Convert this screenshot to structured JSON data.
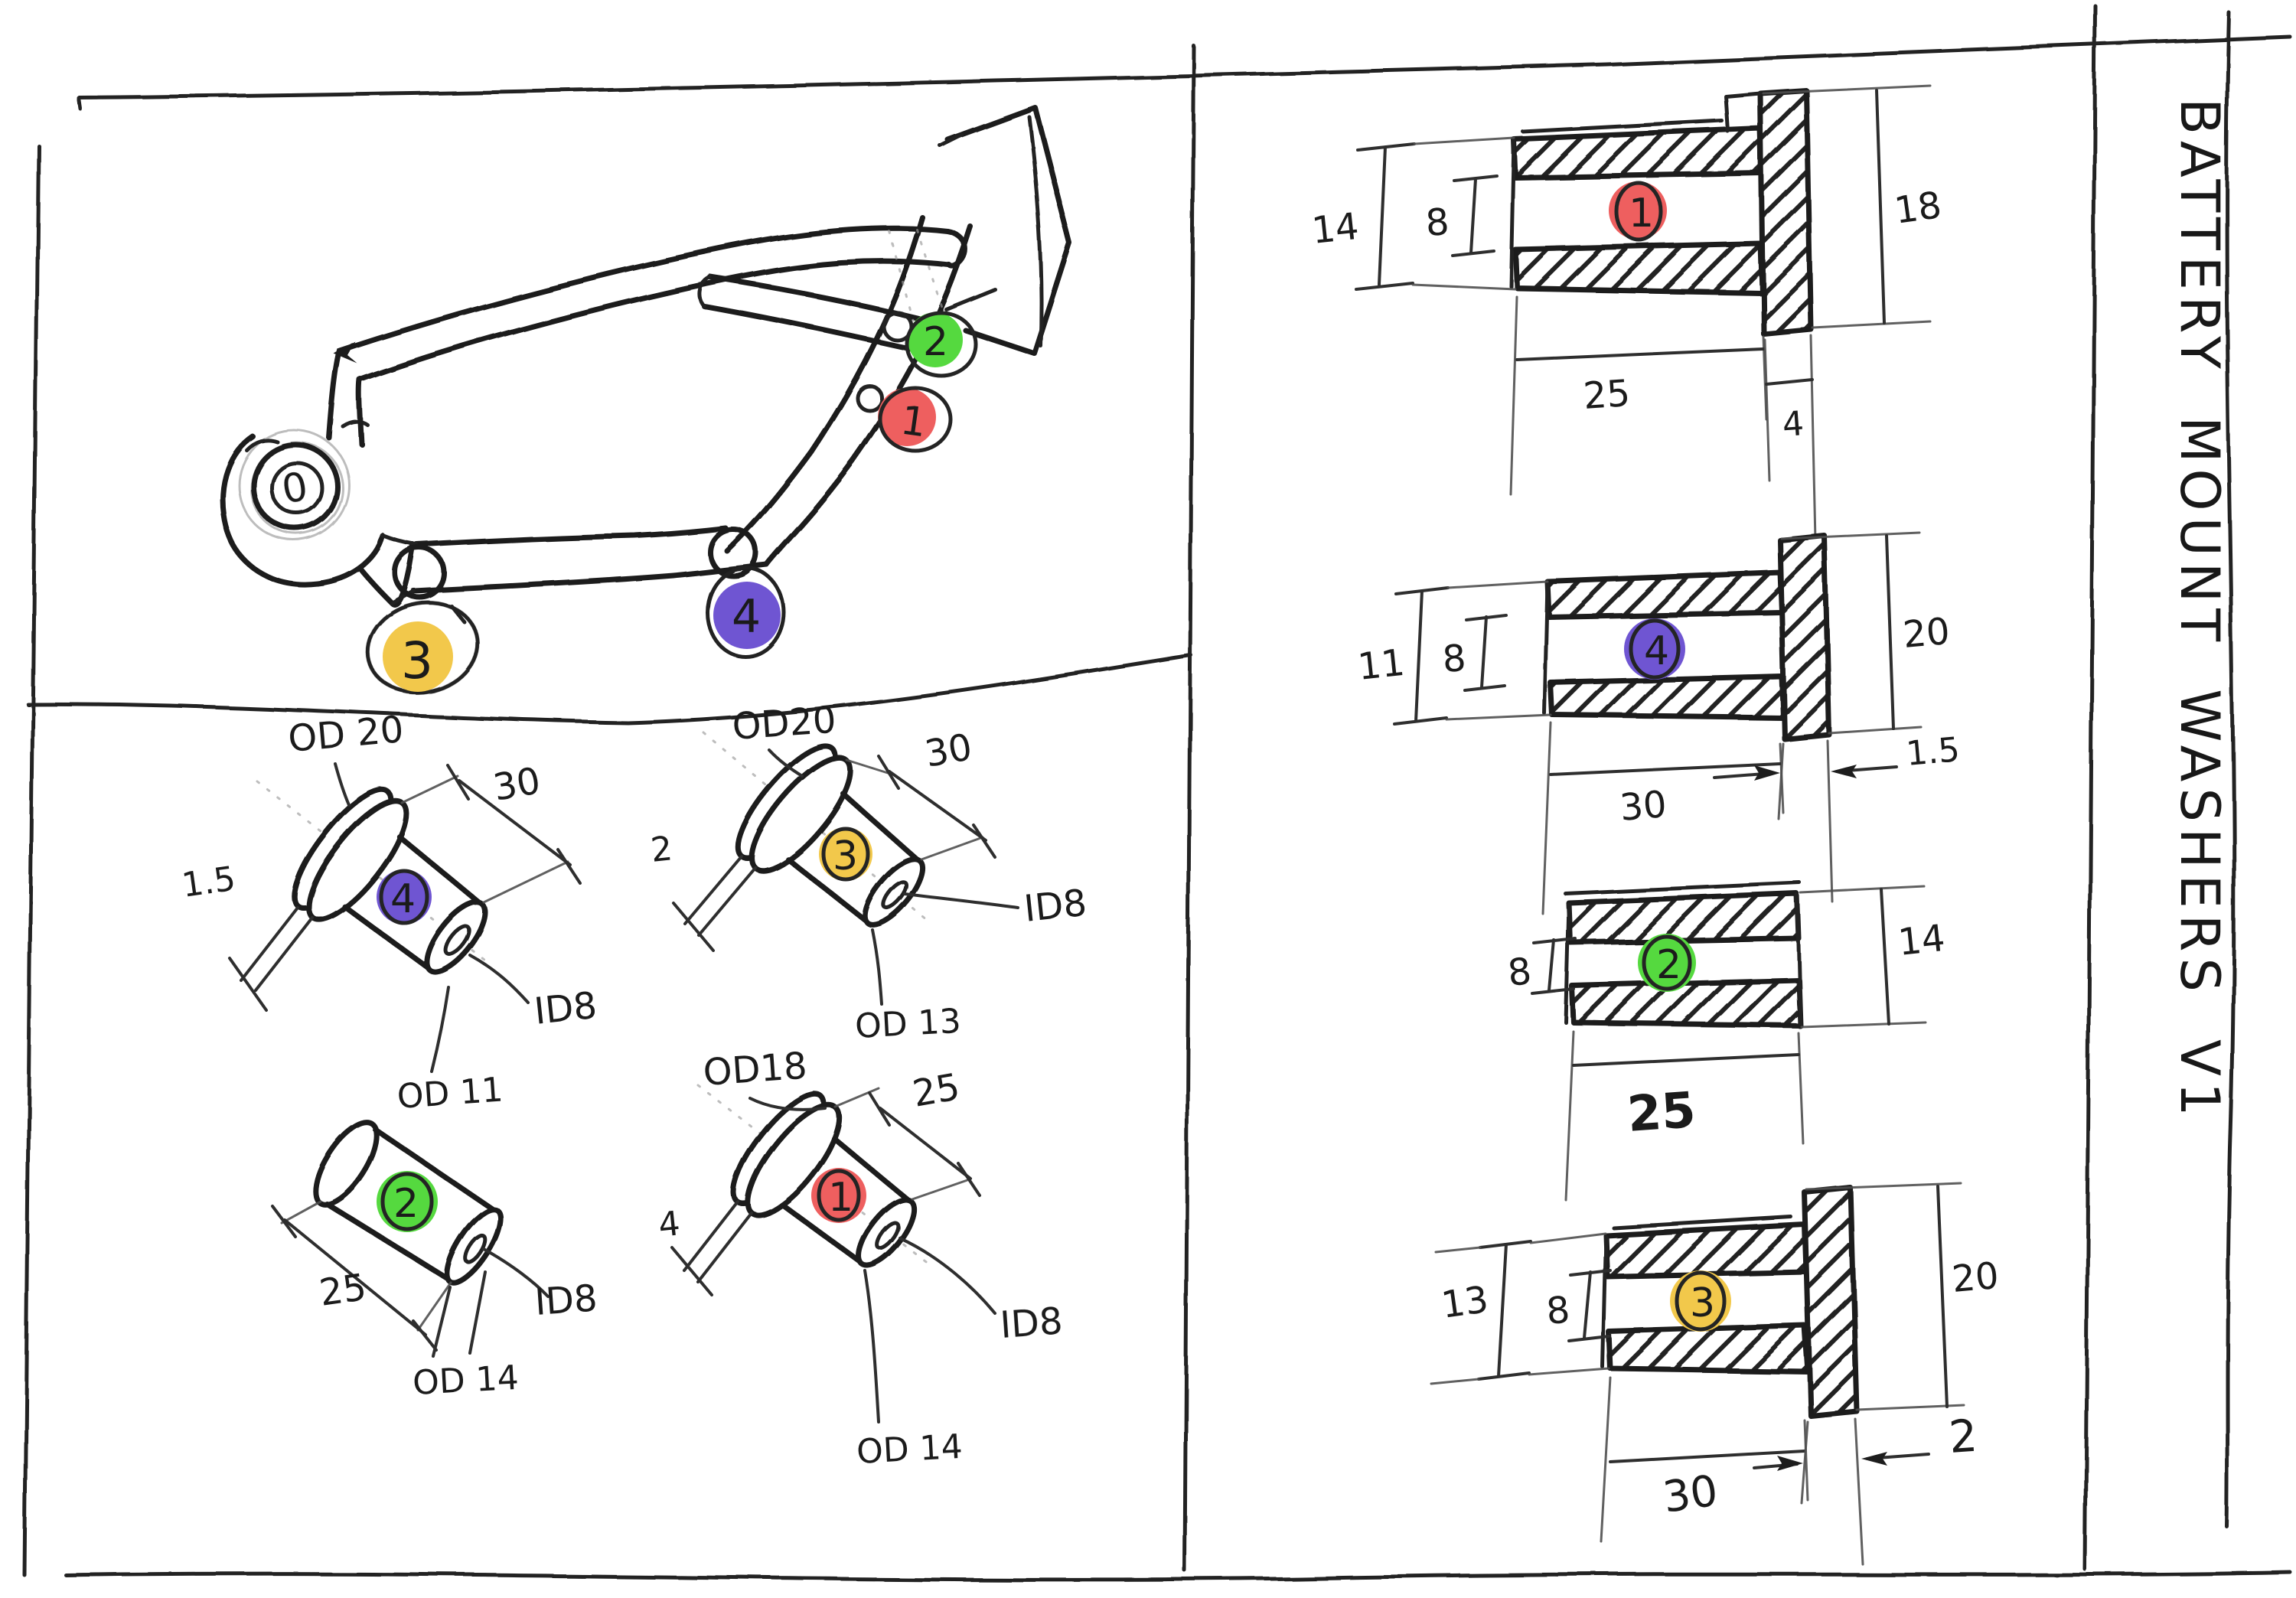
{
  "title": {
    "text": "BATTERY MOUNT WASHERS V1"
  },
  "colors": {
    "ink": "#1d1d1d",
    "red": "#ee5f5f",
    "green": "#55d93f",
    "yellow": "#f2c84b",
    "purple": "#6f55d2",
    "paper": "#ffffff"
  },
  "frame": {
    "hub_label": "0",
    "markers": [
      {
        "num": "1"
      },
      {
        "num": "2"
      },
      {
        "num": "3"
      },
      {
        "num": "4"
      }
    ]
  },
  "iso": {
    "p4": {
      "num": "4",
      "od_top": "OD 20",
      "length": "30",
      "flange": "1.5",
      "bore": "ID8",
      "od_end": "OD 11"
    },
    "p3": {
      "num": "3",
      "od_top": "OD20",
      "length": "30",
      "flange": "2",
      "bore": "ID8",
      "od_end": "OD 13"
    },
    "p2": {
      "num": "2",
      "length": "25",
      "bore": "ID8",
      "od_end": "OD 14"
    },
    "p1": {
      "num": "1",
      "od_top": "OD18",
      "length": "25",
      "flange": "4",
      "bore": "ID8",
      "od_end": "OD 14"
    }
  },
  "sections": {
    "p1": {
      "num": "1",
      "od": "14",
      "bore": "8",
      "flange_od": "18",
      "length": "25",
      "flange_t": "4"
    },
    "p4": {
      "num": "4",
      "od": "11",
      "bore": "8",
      "flange_od": "20",
      "length": "30",
      "flange_t": "1.5"
    },
    "p2": {
      "num": "2",
      "bore": "8",
      "od": "14",
      "length": "25"
    },
    "p3": {
      "num": "3",
      "od": "13",
      "bore": "8",
      "flange_od": "20",
      "length": "30",
      "flange_t": "2"
    }
  }
}
